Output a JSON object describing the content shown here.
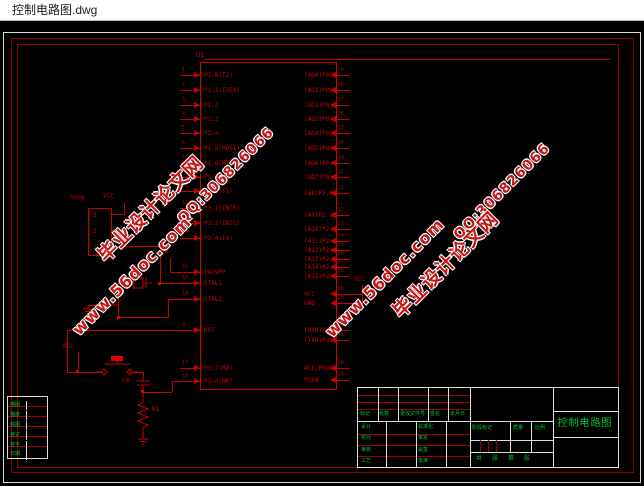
{
  "window": {
    "title": "控制电路图.dwg"
  },
  "watermark": {
    "site": "毕业设计论文网",
    "qq": "QQ:306826066",
    "url": "www.56doc.com"
  },
  "schematic": {
    "chip": {
      "ref": "U1",
      "left_pins": [
        {
          "num": "1",
          "label": "P1.0(T2)",
          "y": 75
        },
        {
          "num": "2",
          "label": "P1.1(T2EX)",
          "y": 90
        },
        {
          "num": "3",
          "label": "P1.2",
          "y": 105
        },
        {
          "num": "4",
          "label": "P1.3",
          "y": 119
        },
        {
          "num": "5",
          "label": "P1.4",
          "y": 133
        },
        {
          "num": "6",
          "label": "P1.5(MOSI)",
          "y": 148
        },
        {
          "num": "7",
          "label": "P1.6(MISO)",
          "y": 163
        },
        {
          "num": "8",
          "label": "P1.7(SCK)",
          "y": 177
        },
        {
          "num": "15",
          "label": "P3.5(T1)",
          "y": 191
        },
        {
          "num": "12",
          "label": "P3.2(INT0)",
          "y": 208
        },
        {
          "num": "13",
          "label": "P3.3(INT1)",
          "y": 223
        },
        {
          "num": "14",
          "label": "P3.4(T0)",
          "y": 238
        },
        {
          "num": "31",
          "label": "EA/VPP",
          "y": 272
        },
        {
          "num": "19",
          "label": "XTAL1",
          "y": 283
        },
        {
          "num": "18",
          "label": "XTAL2",
          "y": 299
        },
        {
          "num": "9",
          "label": "RST",
          "y": 330
        },
        {
          "num": "17",
          "label": "P3.7(RD)",
          "y": 368
        },
        {
          "num": "16",
          "label": "P3.6(WR)",
          "y": 381
        }
      ],
      "right_pins": [
        {
          "num": "39",
          "label": "(AD0)P0.0",
          "y": 75
        },
        {
          "num": "38",
          "label": "(AD1)P0.1",
          "y": 90
        },
        {
          "num": "37",
          "label": "(AD2)P0.2",
          "y": 105
        },
        {
          "num": "36",
          "label": "(AD3)P0.3",
          "y": 119
        },
        {
          "num": "35",
          "label": "(AD4)P0.4",
          "y": 133
        },
        {
          "num": "34",
          "label": "(AD5)P0.5",
          "y": 148
        },
        {
          "num": "33",
          "label": "(AD6)P0.6",
          "y": 163
        },
        {
          "num": "32",
          "label": "(AD7)P0.7",
          "y": 177
        },
        {
          "num": "21",
          "label": "(A8)P2.0",
          "y": 193
        },
        {
          "num": "22",
          "label": "(A9)P2.1",
          "y": 215
        },
        {
          "num": "23",
          "label": "(A10)P2.2",
          "y": 229
        },
        {
          "num": "24",
          "label": "(A11)P2.3",
          "y": 241
        },
        {
          "num": "25",
          "label": "(A12)P2.4",
          "y": 250
        },
        {
          "num": "26",
          "label": "(A13)P2.5",
          "y": 259
        },
        {
          "num": "27",
          "label": "(A14)P2.6",
          "y": 267
        },
        {
          "num": "28",
          "label": "(A15)P2.7",
          "y": 276
        },
        {
          "num": "40",
          "label": "VCC",
          "y": 294
        },
        {
          "num": "20",
          "label": "GND",
          "y": 303
        },
        {
          "num": "10",
          "label": "(RXD)P3.0",
          "y": 330
        },
        {
          "num": "11",
          "label": "(TXD)P3.1",
          "y": 340
        },
        {
          "num": "30",
          "label": "ALE/PROG",
          "y": 368
        },
        {
          "num": "29",
          "label": "PSEN",
          "y": 380
        }
      ]
    },
    "labels": {
      "connector": "hong",
      "conn_pin3": "3",
      "conn_pin2": "2",
      "conn_pin1": "1",
      "vcc_a": "VCC",
      "vcc_b": "VCC",
      "vcc_c": "VCC",
      "net_rx": "RX",
      "c4": "C4",
      "r1": "R1"
    }
  },
  "title_block": {
    "rev_header": [
      "标记",
      "处数",
      "更改文件号",
      "签名",
      "年月日"
    ],
    "sign_rows": [
      [
        "设计",
        "标准化"
      ],
      [
        "校对",
        "审定"
      ],
      [
        "审核",
        "会签"
      ],
      [
        "工艺",
        "批准"
      ]
    ],
    "stage_header": [
      "阶段标记",
      "质量",
      "比例"
    ],
    "sheet_line": "共 张 第 张",
    "drawing_title": "控制电路图"
  },
  "margin_block": {
    "rows": [
      "描图",
      "描校",
      "底图",
      "装订",
      "签字",
      "日期"
    ]
  },
  "colors": {
    "wire": "#c80000",
    "frame": "#8e0000",
    "green_text": "#00c832",
    "watermark_red": "#c81616",
    "titlebar_bg": "#ffffff"
  }
}
